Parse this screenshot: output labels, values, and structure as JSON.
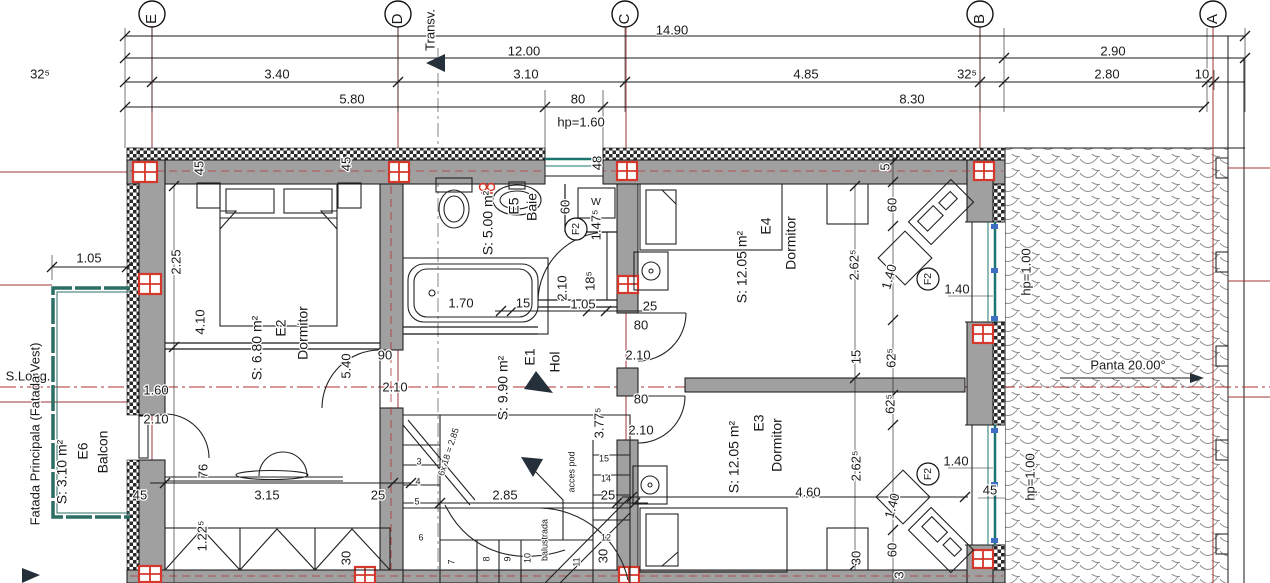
{
  "drawing": {
    "type": "architectural-floor-plan",
    "colors": {
      "wall_fill": "#a0a0a0",
      "column_red": "#d4372c",
      "grid_red": "#a03535",
      "window_teal": "#1c7470",
      "symbol_blue": "#3f6fc4",
      "line_black": "#1a1a1a"
    },
    "grid_axes": [
      {
        "t": "E",
        "x": 152,
        "y": 19,
        "r": -90,
        "s": 15
      },
      {
        "t": "D",
        "x": 398,
        "y": 19,
        "r": -90,
        "s": 15
      },
      {
        "t": "C",
        "x": 625,
        "y": 19,
        "r": -90,
        "s": 15
      },
      {
        "t": "B",
        "x": 980,
        "y": 19,
        "r": -90,
        "s": 15
      },
      {
        "t": "A",
        "x": 1213,
        "y": 19,
        "r": -90,
        "s": 15
      }
    ],
    "rooms": [
      {
        "id": "E1",
        "name": "Hol",
        "area": "S: 9.90 m²",
        "nx": 556,
        "ny": 362,
        "ix": 531,
        "iy": 357,
        "ax": 504,
        "ay": 388
      },
      {
        "id": "E2",
        "name": "Dormitor",
        "area": "S: 6.80 m²",
        "nx": 304,
        "ny": 333,
        "ix": 282,
        "iy": 328,
        "ax": 258,
        "ay": 348
      },
      {
        "id": "E3",
        "name": "Dormitor",
        "area": "S: 12.05 m²",
        "nx": 778,
        "ny": 445,
        "ix": 760,
        "iy": 423,
        "ax": 735,
        "ay": 457
      },
      {
        "id": "E4",
        "name": "Dormitor",
        "area": "S: 12.05 m²",
        "nx": 792,
        "ny": 243,
        "ix": 767,
        "iy": 226,
        "ax": 743,
        "ay": 267
      },
      {
        "id": "E5",
        "name": "Baie",
        "area": "S: 5.00 m²",
        "nx": 533,
        "ny": 207,
        "ix": 515,
        "iy": 206,
        "ax": 489,
        "ay": 223
      },
      {
        "id": "E6",
        "name": "Balcon",
        "area": "S: 3.10 m²",
        "nx": 104,
        "ny": 452,
        "ix": 84,
        "iy": 451,
        "ax": 63,
        "ay": 472,
        "s": 13
      }
    ],
    "labels": {
      "dims": [
        {
          "t": "14.90",
          "x": 672,
          "y": 31
        },
        {
          "t": "12.00",
          "x": 524,
          "y": 52
        },
        {
          "t": "2.90",
          "x": 1113,
          "y": 52
        },
        {
          "t": "32⁵",
          "x": 40,
          "y": 75
        },
        {
          "t": "3.40",
          "x": 277,
          "y": 75
        },
        {
          "t": "3.10",
          "x": 526,
          "y": 75
        },
        {
          "t": "4.85",
          "x": 806,
          "y": 75
        },
        {
          "t": "32⁵",
          "x": 967,
          "y": 75
        },
        {
          "t": "2.80",
          "x": 1107,
          "y": 75
        },
        {
          "t": "10",
          "x": 1202,
          "y": 75
        },
        {
          "t": "5.80",
          "x": 352,
          "y": 100
        },
        {
          "t": "80",
          "x": 578,
          "y": 100
        },
        {
          "t": "8.30",
          "x": 912,
          "y": 100
        },
        {
          "t": "hp=1.60",
          "x": 581,
          "y": 123
        },
        {
          "t": "1.05",
          "x": 89,
          "y": 259
        },
        {
          "t": "2.25",
          "x": 177,
          "y": 262,
          "r": -90
        },
        {
          "t": "4.10",
          "x": 201,
          "y": 322,
          "r": -90
        },
        {
          "t": "45",
          "x": 200,
          "y": 168,
          "r": -90,
          "s": 10
        },
        {
          "t": "45",
          "x": 347,
          "y": 164,
          "r": -90,
          "s": 10
        },
        {
          "t": "48",
          "x": 598,
          "y": 163,
          "r": -90,
          "s": 10
        },
        {
          "t": "45",
          "x": 140,
          "y": 496,
          "s": 11
        },
        {
          "t": "3.15",
          "x": 267,
          "y": 496
        },
        {
          "t": "25",
          "x": 378,
          "y": 496,
          "s": 12
        },
        {
          "t": "76",
          "x": 204,
          "y": 471,
          "r": -90,
          "s": 11
        },
        {
          "t": "1.22⁵",
          "x": 203,
          "y": 536,
          "r": -90,
          "s": 11
        },
        {
          "t": "30",
          "x": 347,
          "y": 558,
          "r": -90,
          "s": 11
        },
        {
          "t": "1.70",
          "x": 461,
          "y": 304
        },
        {
          "t": "15",
          "x": 523,
          "y": 304,
          "s": 12
        },
        {
          "t": "1.05",
          "x": 583,
          "y": 305
        },
        {
          "t": "25",
          "x": 650,
          "y": 307,
          "s": 12
        },
        {
          "t": "60",
          "x": 566,
          "y": 207,
          "r": -90,
          "s": 11
        },
        {
          "t": "1.47⁵",
          "x": 597,
          "y": 225,
          "r": -90,
          "s": 11
        },
        {
          "t": "18⁵",
          "x": 591,
          "y": 281,
          "r": -90,
          "s": 10
        },
        {
          "t": "2.10",
          "x": 563,
          "y": 288,
          "r": -90,
          "s": 11
        },
        {
          "t": "5",
          "x": 886,
          "y": 167,
          "r": -90,
          "s": 10
        },
        {
          "t": "60",
          "x": 893,
          "y": 205,
          "r": -90,
          "s": 11
        },
        {
          "t": "2.62⁵",
          "x": 855,
          "y": 265,
          "r": -90,
          "s": 11
        },
        {
          "t": "1.40",
          "x": 890,
          "y": 277,
          "r": -75,
          "s": 11
        },
        {
          "t": "62⁵",
          "x": 892,
          "y": 358,
          "r": -90,
          "s": 11
        },
        {
          "t": "15",
          "x": 857,
          "y": 357,
          "r": -90,
          "s": 10
        },
        {
          "t": "1.40",
          "x": 957,
          "y": 290,
          "s": 12
        },
        {
          "t": "62⁵",
          "x": 891,
          "y": 404,
          "r": -90,
          "s": 11
        },
        {
          "t": "2.62⁵",
          "x": 857,
          "y": 466,
          "r": -90,
          "s": 11
        },
        {
          "t": "1.40",
          "x": 893,
          "y": 506,
          "r": -75,
          "s": 11
        },
        {
          "t": "60",
          "x": 893,
          "y": 550,
          "r": -90,
          "s": 11
        },
        {
          "t": "30",
          "x": 857,
          "y": 558,
          "r": -90,
          "s": 11
        },
        {
          "t": "3",
          "x": 900,
          "y": 575,
          "r": -90,
          "s": 10
        },
        {
          "t": "1.40",
          "x": 956,
          "y": 462,
          "s": 12
        },
        {
          "t": "45",
          "x": 990,
          "y": 491,
          "s": 12
        },
        {
          "t": "4.60",
          "x": 808,
          "y": 493
        },
        {
          "t": "2.85",
          "x": 505,
          "y": 496
        },
        {
          "t": "25",
          "x": 608,
          "y": 496,
          "s": 12
        },
        {
          "t": "3.77⁵",
          "x": 600,
          "y": 423,
          "r": -90,
          "s": 11
        },
        {
          "t": "30",
          "x": 604,
          "y": 556,
          "r": -90,
          "s": 11
        }
      ],
      "doors": [
        {
          "t": "90",
          "x": 385,
          "y": 356,
          "s": 12
        },
        {
          "t": "2.10",
          "x": 395,
          "y": 388,
          "s": 12
        },
        {
          "t": "5.40",
          "x": 347,
          "y": 366,
          "r": -90,
          "s": 11
        },
        {
          "t": "1.60",
          "x": 156,
          "y": 391,
          "s": 12
        },
        {
          "t": "2.10",
          "x": 156,
          "y": 420,
          "s": 12
        },
        {
          "t": "80",
          "x": 641,
          "y": 326,
          "s": 12
        },
        {
          "t": "2.10",
          "x": 638,
          "y": 356,
          "s": 12
        },
        {
          "t": "80",
          "x": 641,
          "y": 400,
          "s": 12
        },
        {
          "t": "2.10",
          "x": 641,
          "y": 431,
          "s": 12
        }
      ],
      "stairs": [
        {
          "t": "acces pod",
          "x": 572,
          "y": 472,
          "r": -90,
          "s": 12
        },
        {
          "t": "balustrada",
          "x": 545,
          "y": 540,
          "r": -90,
          "s": 12
        },
        {
          "t": "6x 18 = 2.85",
          "x": 449,
          "y": 452,
          "r": -72,
          "s": 8.5
        },
        {
          "t": "3",
          "x": 419,
          "y": 462
        },
        {
          "t": "4",
          "x": 418,
          "y": 482
        },
        {
          "t": "5",
          "x": 417,
          "y": 502
        },
        {
          "t": "6",
          "x": 421,
          "y": 538
        },
        {
          "t": "7",
          "x": 452,
          "y": 562,
          "r": -90
        },
        {
          "t": "8",
          "x": 487,
          "y": 559,
          "r": -90
        },
        {
          "t": "9",
          "x": 508,
          "y": 559,
          "r": -90
        },
        {
          "t": "10",
          "x": 528,
          "y": 558,
          "r": -90
        },
        {
          "t": "11",
          "x": 577,
          "y": 562,
          "r": -90
        },
        {
          "t": "12",
          "x": 606,
          "y": 538
        },
        {
          "t": "14",
          "x": 606,
          "y": 479
        },
        {
          "t": "15",
          "x": 604,
          "y": 459
        }
      ],
      "sections": [
        {
          "t": "Transv.",
          "x": 431,
          "y": 30,
          "r": -90,
          "s": 13
        },
        {
          "t": "S.Long.",
          "x": 28,
          "y": 377,
          "s": 13
        },
        {
          "t": "Fatada Principala (Fatada Vest)",
          "x": 36,
          "y": 434,
          "r": -90,
          "s": 15.5
        }
      ],
      "roof": [
        {
          "t": "hp=1.00",
          "x": 1027,
          "y": 272,
          "r": -90
        },
        {
          "t": "hp=1.00",
          "x": 1031,
          "y": 477,
          "r": -90
        },
        {
          "t": "Panta 20.00°",
          "x": 1128,
          "y": 366,
          "s": 18
        }
      ],
      "symbols": [
        {
          "t": "F2",
          "x": 576,
          "y": 229,
          "r": -90,
          "s": 10.5
        },
        {
          "t": "F2",
          "x": 928,
          "y": 279,
          "r": -90,
          "s": 10.5
        },
        {
          "t": "F2",
          "x": 928,
          "y": 474,
          "r": -90,
          "s": 10.5
        },
        {
          "t": "W",
          "x": 596,
          "y": 202,
          "s": 11,
          "c": "#3f6fc4"
        }
      ]
    }
  }
}
